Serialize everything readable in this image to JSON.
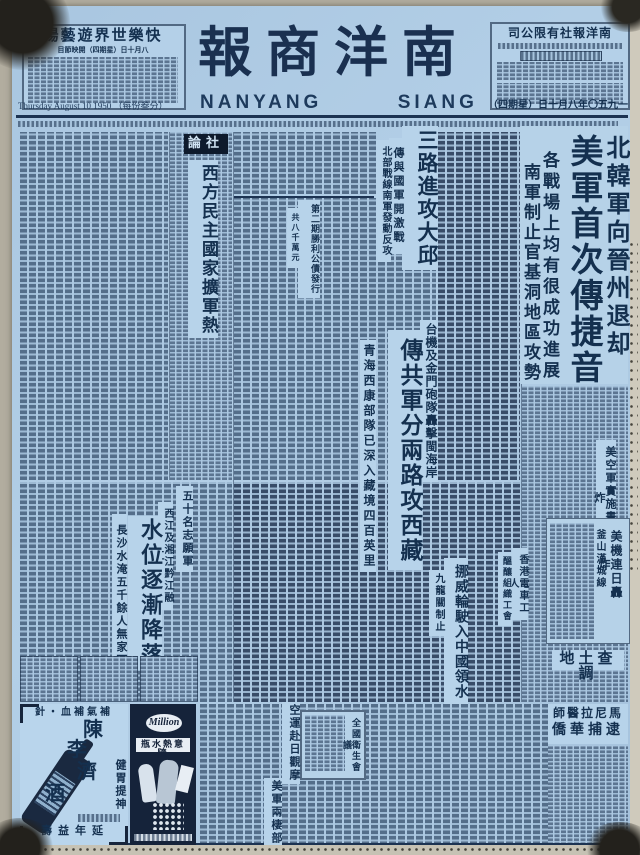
{
  "colors": {
    "paper": "#adc9e2",
    "ink": "#16304f",
    "badge_bg": "#0e1a2c"
  },
  "header": {
    "left_ad": {
      "title": "場藝遊界世樂快",
      "subtitle": "目節映開（四期星）日十月八"
    },
    "masthead": {
      "chinese": "報商洋南",
      "latin_1": "NANYANG",
      "latin_2": "SIANG",
      "latin_3": "PAU"
    },
    "right_box": {
      "title": "司公限有社報洋南"
    },
    "dateline_left": "Thursday  August  10  1950 （每份叁分）",
    "dateline_right": "（四期星）日十月八年〇五九一"
  },
  "editorial": {
    "badge": "論社",
    "title": "西方民主國家擴軍熱"
  },
  "headlines": {
    "korea": {
      "kicker": "北韓軍向晉州退却",
      "main": "美軍首次傳捷音",
      "sub1": "各戰場上均有很成功進展",
      "sub2": "南軍制止官基洞地區攻勢"
    },
    "taegu": {
      "main": "三路進攻大邱",
      "sub1": "傳與國軍開激戰",
      "sub2": "北部戰線南軍發動反攻"
    },
    "bonds": {
      "main": "第二期勝利公債發行",
      "sub": "共八千萬元"
    },
    "tibet": {
      "kicker": "台機及金門砲隊轟擊閩海岸",
      "main": "傳共軍分兩路攻西藏",
      "sub": "青海西康部隊已深入藏境四百英里"
    },
    "us_air": {
      "main": "美空軍實施晝夜轟炸"
    },
    "busan": {
      "main": "美機連日轟炸",
      "sub": "釜山漢城線"
    },
    "flood": {
      "kicker": "西江及湘江黔江融江",
      "main": "水位逐漸降落",
      "sub": "長沙水淹五千餘人無家可歸"
    },
    "volunteers": {
      "main": "五十名志願軍"
    },
    "norway": {
      "main": "挪威輪駛入中國領水",
      "sub": "九龍關制止"
    },
    "hk_tram": {
      "main": "香港電車工人",
      "sub": "醞釀組織工會"
    },
    "land_survey": {
      "main": "地土查調"
    },
    "manila": {
      "line1": "師醫拉尼馬",
      "line2": "僑華捕逮"
    },
    "health": {
      "main": "全國衛生會議"
    },
    "japan": {
      "main": "空運赴日觀摩"
    },
    "amphibious": {
      "main": "美軍兩棲部隊"
    }
  },
  "ads": {
    "chen_li_ji": {
      "slogan_top": "針・血補氣補",
      "brand_1": "陳",
      "brand_2": "李",
      "brand_3": "濟",
      "brand_4": "酒",
      "slogan_right": "健胃提神",
      "slogan_bottom": "壽益年延"
    },
    "million": {
      "logo": "Million",
      "band": "瓶水熱意隨"
    }
  }
}
